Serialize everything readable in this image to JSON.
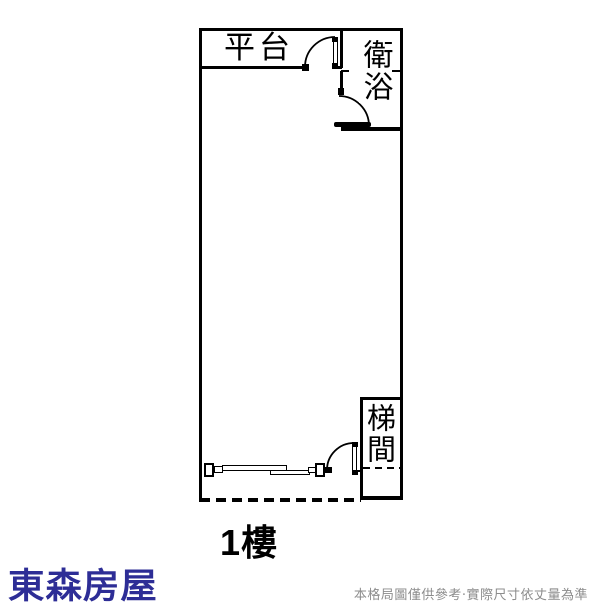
{
  "plan": {
    "floor_label": "1樓",
    "rooms": {
      "platform": {
        "label": "平台"
      },
      "bathroom": {
        "label": "衛浴"
      },
      "stairwell": {
        "label": "梯間"
      }
    },
    "symbols": {
      "doors": [
        "platform-door",
        "bathroom-door",
        "entrance-door"
      ],
      "window": "sliding-window",
      "dashed_boundary": "bottom-property-line"
    },
    "line_color": "#000000",
    "background": "#ffffff"
  },
  "footer": {
    "brand": "東森房屋",
    "brand_color": "#2d2d96",
    "disclaimer": "本格局圖僅供參考‧實際尺寸依丈量為準",
    "disclaimer_color": "#8c8c8c"
  }
}
